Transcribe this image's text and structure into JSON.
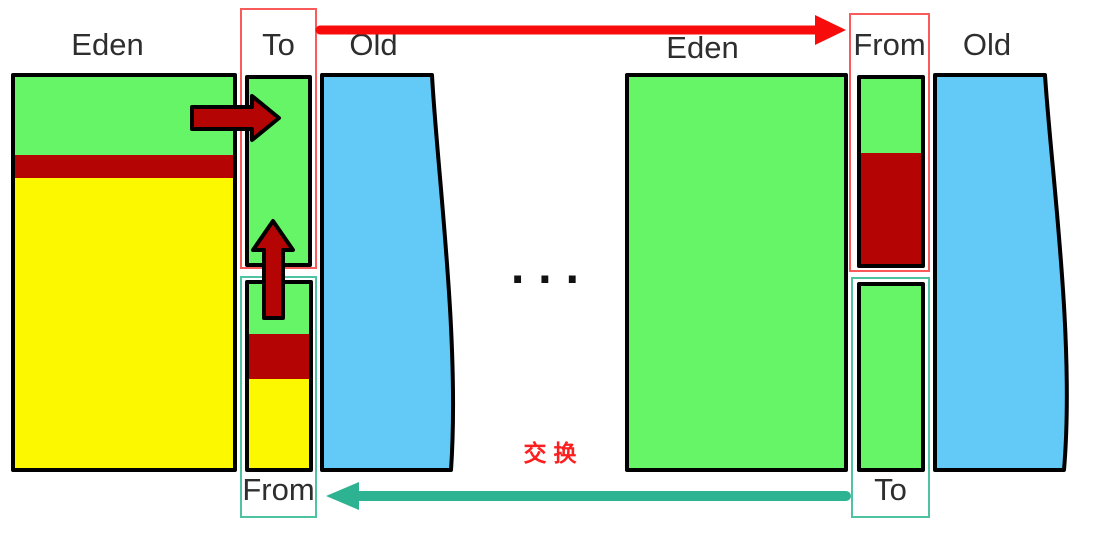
{
  "colors": {
    "green": "#66F566",
    "yellow": "#FCF800",
    "dark-red": "#B40404",
    "blue": "#63CAF7",
    "bright-red": "#F80B0B",
    "teal": "#2EB392",
    "box-red": "#F95B5B",
    "box-teal": "#4FC3A1",
    "label-text": "#2E2E2E",
    "swap-text": "#FB1F1F"
  },
  "left_heap": {
    "eden": {
      "label": "Eden",
      "segments": [
        {
          "color": "green",
          "h": 78
        },
        {
          "color": "dark-red",
          "h": 23
        },
        {
          "color": "yellow"
        }
      ]
    },
    "survivor_to": {
      "label": "To",
      "segments": [
        {
          "color": "green"
        }
      ]
    },
    "survivor_from": {
      "label": "From",
      "segments": [
        {
          "color": "green",
          "h": 50
        },
        {
          "color": "dark-red",
          "h": 45
        },
        {
          "color": "yellow"
        }
      ]
    },
    "old": {
      "label": "Old"
    }
  },
  "right_heap": {
    "eden": {
      "label": "Eden",
      "segments": [
        {
          "color": "green"
        }
      ]
    },
    "survivor_from": {
      "label": "From",
      "segments": [
        {
          "color": "green",
          "h": 74
        },
        {
          "color": "dark-red"
        }
      ]
    },
    "survivor_to": {
      "label": "To",
      "segments": [
        {
          "color": "green"
        }
      ]
    },
    "old": {
      "label": "Old"
    }
  },
  "middle": {
    "ellipsis": "...",
    "swap_label": "交换"
  }
}
